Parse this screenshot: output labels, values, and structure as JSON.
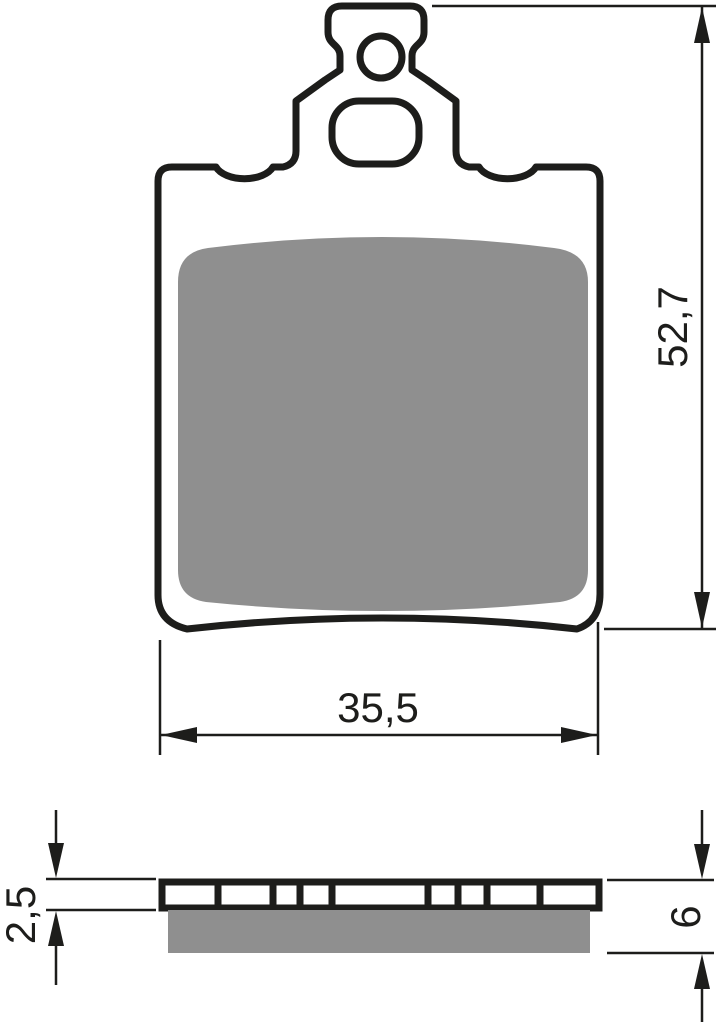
{
  "title": "Brake pad technical drawing",
  "colors": {
    "line": "#1d1d1b",
    "friction_gray": "#8f8f8f",
    "background": "#ffffff"
  },
  "front_view": {
    "height_dimension": "52,7",
    "width_dimension": "35,5"
  },
  "side_view": {
    "backplate_thickness": "2,5",
    "total_thickness": "6"
  }
}
